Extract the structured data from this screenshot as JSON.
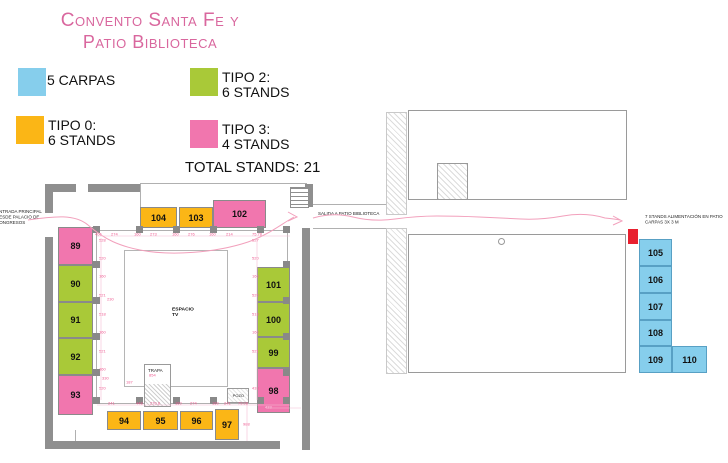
{
  "title": {
    "line1": "Convento Santa Fe y",
    "line2": "Patio Biblioteca"
  },
  "legend": {
    "items": [
      {
        "id": "carpas",
        "color": "#86CEEC",
        "line1": "5 CARPAS",
        "line2": ""
      },
      {
        "id": "tipo2",
        "color": "#A9C938",
        "line1": "TIPO 2:",
        "line2": "6 STANDS"
      },
      {
        "id": "tipo0",
        "color": "#FBB616",
        "line1": "TIPO 0:",
        "line2": "6 STANDS"
      },
      {
        "id": "tipo3",
        "color": "#F176AE",
        "line1": "TIPO 3:",
        "line2": "4 STANDS"
      }
    ],
    "total": "TOTAL STANDS: 21"
  },
  "colors": {
    "carpa": "#86CEEC",
    "carpa_border": "#58A0C4",
    "tipo0": "#FBB616",
    "tipo2": "#A9C938",
    "tipo3": "#F176AE",
    "wall": "#8f8f8f",
    "path_pink": "#F2A0BC",
    "dim_pink": "#EE5C92",
    "red_marker": "#E8202F",
    "title_pink": "#D9679E"
  },
  "plan": {
    "entrance_lines": [
      "ENTRADA PRINCIPAL",
      "DESDE PALACIO DE",
      "CONGRESOS"
    ],
    "exit_label": "SALIDA A PATIO BIBLIOTECA",
    "espacio_lines": [
      "ESPACIO",
      "TV"
    ],
    "trapa_label": "TRAPA",
    "pozo_label": "POZO",
    "stands": [
      {
        "label": "89",
        "type": "tipo3",
        "x": 58,
        "y": 227,
        "w": 35,
        "h": 38
      },
      {
        "label": "90",
        "type": "tipo2",
        "x": 58,
        "y": 265,
        "w": 35,
        "h": 37
      },
      {
        "label": "91",
        "type": "tipo2",
        "x": 58,
        "y": 302,
        "w": 35,
        "h": 36
      },
      {
        "label": "92",
        "type": "tipo2",
        "x": 58,
        "y": 338,
        "w": 35,
        "h": 37
      },
      {
        "label": "93",
        "type": "tipo3",
        "x": 58,
        "y": 375,
        "w": 35,
        "h": 40
      },
      {
        "label": "104",
        "type": "tipo0",
        "x": 140,
        "y": 207,
        "w": 37,
        "h": 21
      },
      {
        "label": "103",
        "type": "tipo0",
        "x": 179,
        "y": 207,
        "w": 34,
        "h": 21
      },
      {
        "label": "102",
        "type": "tipo3",
        "x": 213,
        "y": 200,
        "w": 53,
        "h": 28
      },
      {
        "label": "101",
        "type": "tipo2",
        "x": 257,
        "y": 267,
        "w": 33,
        "h": 35
      },
      {
        "label": "100",
        "type": "tipo2",
        "x": 257,
        "y": 302,
        "w": 33,
        "h": 35
      },
      {
        "label": "99",
        "type": "tipo2",
        "x": 257,
        "y": 337,
        "w": 33,
        "h": 31
      },
      {
        "label": "98",
        "type": "tipo3",
        "x": 257,
        "y": 368,
        "w": 33,
        "h": 45
      },
      {
        "label": "94",
        "type": "tipo0",
        "x": 107,
        "y": 411,
        "w": 34,
        "h": 19
      },
      {
        "label": "95",
        "type": "tipo0",
        "x": 143,
        "y": 411,
        "w": 35,
        "h": 19
      },
      {
        "label": "96",
        "type": "tipo0",
        "x": 180,
        "y": 411,
        "w": 33,
        "h": 19
      },
      {
        "label": "97",
        "type": "tipo0",
        "x": 215,
        "y": 409,
        "w": 24,
        "h": 31
      }
    ],
    "pilasters": [
      [
        93,
        226
      ],
      [
        136,
        226
      ],
      [
        173,
        226
      ],
      [
        210,
        226
      ],
      [
        257,
        226
      ],
      [
        283,
        226
      ],
      [
        93,
        397
      ],
      [
        136,
        397
      ],
      [
        173,
        397
      ],
      [
        210,
        397
      ],
      [
        257,
        397
      ],
      [
        283,
        397
      ],
      [
        93,
        261
      ],
      [
        93,
        297
      ],
      [
        93,
        333
      ],
      [
        93,
        369
      ],
      [
        283,
        261
      ],
      [
        283,
        297
      ],
      [
        283,
        333
      ],
      [
        283,
        369
      ]
    ]
  },
  "right": {
    "annotation_lines": [
      "7 STANDS ALIMENTACIÓN EN PATIO",
      "CARPAS 3X 3 M"
    ],
    "red_marker": {
      "x": 628,
      "y": 229,
      "w": 10,
      "h": 15
    },
    "stands": [
      {
        "label": "105",
        "type": "carpa",
        "x": 639,
        "y": 239,
        "w": 33,
        "h": 27
      },
      {
        "label": "106",
        "type": "carpa",
        "x": 639,
        "y": 266,
        "w": 33,
        "h": 27
      },
      {
        "label": "107",
        "type": "carpa",
        "x": 639,
        "y": 293,
        "w": 33,
        "h": 27
      },
      {
        "label": "108",
        "type": "carpa",
        "x": 639,
        "y": 320,
        "w": 33,
        "h": 26
      },
      {
        "label": "109",
        "type": "carpa",
        "x": 639,
        "y": 346,
        "w": 33,
        "h": 27
      },
      {
        "label": "110",
        "type": "carpa",
        "x": 672,
        "y": 346,
        "w": 35,
        "h": 27
      }
    ]
  },
  "dims": [
    {
      "t": "406",
      "x": 95,
      "y": 232
    },
    {
      "t": "274",
      "x": 111,
      "y": 232
    },
    {
      "t": "160",
      "x": 134,
      "y": 232
    },
    {
      "t": "273",
      "x": 150,
      "y": 232
    },
    {
      "t": "160",
      "x": 172,
      "y": 232
    },
    {
      "t": "276",
      "x": 188,
      "y": 232
    },
    {
      "t": "160",
      "x": 209,
      "y": 232
    },
    {
      "t": "214",
      "x": 226,
      "y": 232
    },
    {
      "t": "75.78",
      "x": 252,
      "y": 232
    },
    {
      "t": "241",
      "x": 108,
      "y": 401
    },
    {
      "t": "448",
      "x": 136,
      "y": 401
    },
    {
      "t": "270.8",
      "x": 150,
      "y": 401
    },
    {
      "t": "160",
      "x": 175,
      "y": 401
    },
    {
      "t": "274",
      "x": 190,
      "y": 401
    },
    {
      "t": "160",
      "x": 212,
      "y": 401
    },
    {
      "t": "241",
      "x": 224,
      "y": 401
    },
    {
      "t": "79.08",
      "x": 238,
      "y": 401
    },
    {
      "t": "528",
      "x": 99,
      "y": 238
    },
    {
      "t": "520",
      "x": 99,
      "y": 256
    },
    {
      "t": "160",
      "x": 99,
      "y": 274
    },
    {
      "t": "521",
      "x": 99,
      "y": 293
    },
    {
      "t": "518",
      "x": 99,
      "y": 312
    },
    {
      "t": "160",
      "x": 99,
      "y": 330
    },
    {
      "t": "521",
      "x": 99,
      "y": 349
    },
    {
      "t": "160",
      "x": 99,
      "y": 367
    },
    {
      "t": "520",
      "x": 99,
      "y": 386
    },
    {
      "t": "527",
      "x": 252,
      "y": 238
    },
    {
      "t": "520",
      "x": 252,
      "y": 256
    },
    {
      "t": "160",
      "x": 252,
      "y": 274
    },
    {
      "t": "520",
      "x": 252,
      "y": 293
    },
    {
      "t": "518",
      "x": 252,
      "y": 312
    },
    {
      "t": "160",
      "x": 252,
      "y": 330
    },
    {
      "t": "521",
      "x": 252,
      "y": 349
    },
    {
      "t": "433",
      "x": 252,
      "y": 386
    },
    {
      "t": "230",
      "x": 107,
      "y": 297
    },
    {
      "t": "330",
      "x": 102,
      "y": 376
    },
    {
      "t": "187",
      "x": 126,
      "y": 380
    },
    {
      "t": "854",
      "x": 149,
      "y": 373
    },
    {
      "t": "433",
      "x": 265,
      "y": 405,
      "c": "light"
    },
    {
      "t": "988",
      "x": 243,
      "y": 422
    }
  ]
}
